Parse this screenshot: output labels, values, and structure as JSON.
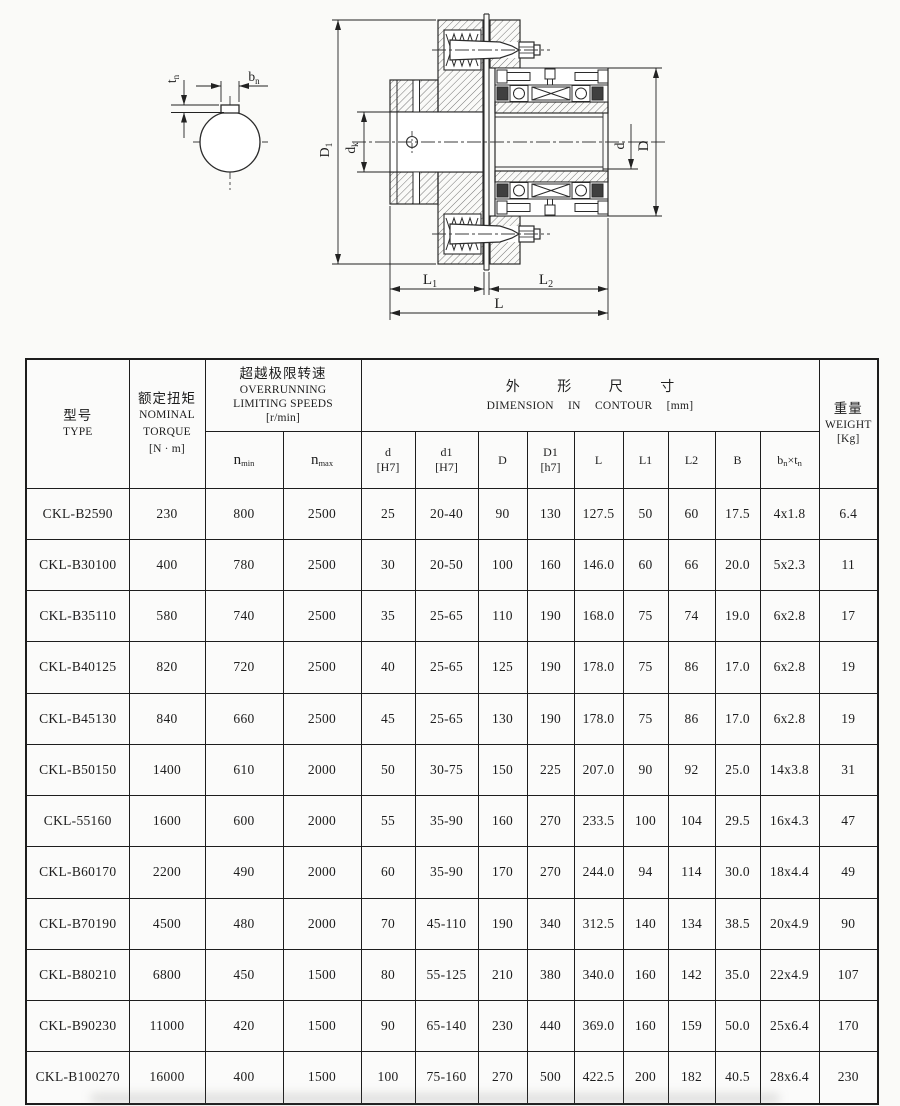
{
  "drawing": {
    "labels": {
      "tn": {
        "main": "t",
        "sub": "n"
      },
      "bn": {
        "main": "b",
        "sub": "n"
      },
      "D1": {
        "main": "D",
        "sub": "1"
      },
      "dk": {
        "main": "d",
        "sub": "k"
      },
      "d": "d",
      "D": "D",
      "L1": {
        "main": "L",
        "sub": "1"
      },
      "L2": {
        "main": "L",
        "sub": "2"
      },
      "L": "L"
    }
  },
  "table": {
    "header": {
      "type_zh": "型号",
      "type_en": "TYPE",
      "torque_zh": "额定扭矩",
      "torque_en1": "NOMINAL",
      "torque_en2": "TORQUE",
      "torque_unit": "[N · m]",
      "speeds_zh": "超越极限转速",
      "speeds_en1": "OVERRUNNING",
      "speeds_en2": "LIMITING SPEEDS",
      "speeds_unit": "[r/min]",
      "nmin": {
        "main": "n",
        "sub": "min"
      },
      "nmax": {
        "main": "n",
        "sub": "max"
      },
      "dims_zh": "外 形 尺 寸",
      "dims_en": "DIMENSION IN CONTOUR [mm]",
      "c_d": {
        "l1": "d",
        "l2": "[H7]"
      },
      "c_d1": {
        "l1": "d1",
        "l2": "[H7]"
      },
      "c_D": "D",
      "c_D1": {
        "l1": "D1",
        "l2": "[h7]"
      },
      "c_L": "L",
      "c_L1": "L1",
      "c_L2": "L2",
      "c_B": "B",
      "c_bntn": {
        "b": "b",
        "bsub": "n",
        "times": "×",
        "t": "t",
        "tsub": "n"
      },
      "weight_zh": "重量",
      "weight_en": "WEIGHT",
      "weight_unit": "[Kg]"
    },
    "rows": [
      [
        "CKL-B2590",
        "230",
        "800",
        "2500",
        "25",
        "20-40",
        "90",
        "130",
        "127.5",
        "50",
        "60",
        "17.5",
        "4x1.8",
        "6.4"
      ],
      [
        "CKL-B30100",
        "400",
        "780",
        "2500",
        "30",
        "20-50",
        "100",
        "160",
        "146.0",
        "60",
        "66",
        "20.0",
        "5x2.3",
        "11"
      ],
      [
        "CKL-B35110",
        "580",
        "740",
        "2500",
        "35",
        "25-65",
        "110",
        "190",
        "168.0",
        "75",
        "74",
        "19.0",
        "6x2.8",
        "17"
      ],
      [
        "CKL-B40125",
        "820",
        "720",
        "2500",
        "40",
        "25-65",
        "125",
        "190",
        "178.0",
        "75",
        "86",
        "17.0",
        "6x2.8",
        "19"
      ],
      [
        "CKL-B45130",
        "840",
        "660",
        "2500",
        "45",
        "25-65",
        "130",
        "190",
        "178.0",
        "75",
        "86",
        "17.0",
        "6x2.8",
        "19"
      ],
      [
        "CKL-B50150",
        "1400",
        "610",
        "2000",
        "50",
        "30-75",
        "150",
        "225",
        "207.0",
        "90",
        "92",
        "25.0",
        "14x3.8",
        "31"
      ],
      [
        "CKL-55160",
        "1600",
        "600",
        "2000",
        "55",
        "35-90",
        "160",
        "270",
        "233.5",
        "100",
        "104",
        "29.5",
        "16x4.3",
        "47"
      ],
      [
        "CKL-B60170",
        "2200",
        "490",
        "2000",
        "60",
        "35-90",
        "170",
        "270",
        "244.0",
        "94",
        "114",
        "30.0",
        "18x4.4",
        "49"
      ],
      [
        "CKL-B70190",
        "4500",
        "480",
        "2000",
        "70",
        "45-110",
        "190",
        "340",
        "312.5",
        "140",
        "134",
        "38.5",
        "20x4.9",
        "90"
      ],
      [
        "CKL-B80210",
        "6800",
        "450",
        "1500",
        "80",
        "55-125",
        "210",
        "380",
        "340.0",
        "160",
        "142",
        "35.0",
        "22x4.9",
        "107"
      ],
      [
        "CKL-B90230",
        "11000",
        "420",
        "1500",
        "90",
        "65-140",
        "230",
        "440",
        "369.0",
        "160",
        "159",
        "50.0",
        "25x6.4",
        "170"
      ],
      [
        "CKL-B100270",
        "16000",
        "400",
        "1500",
        "100",
        "75-160",
        "270",
        "500",
        "422.5",
        "200",
        "182",
        "40.5",
        "28x6.4",
        "230"
      ]
    ]
  }
}
